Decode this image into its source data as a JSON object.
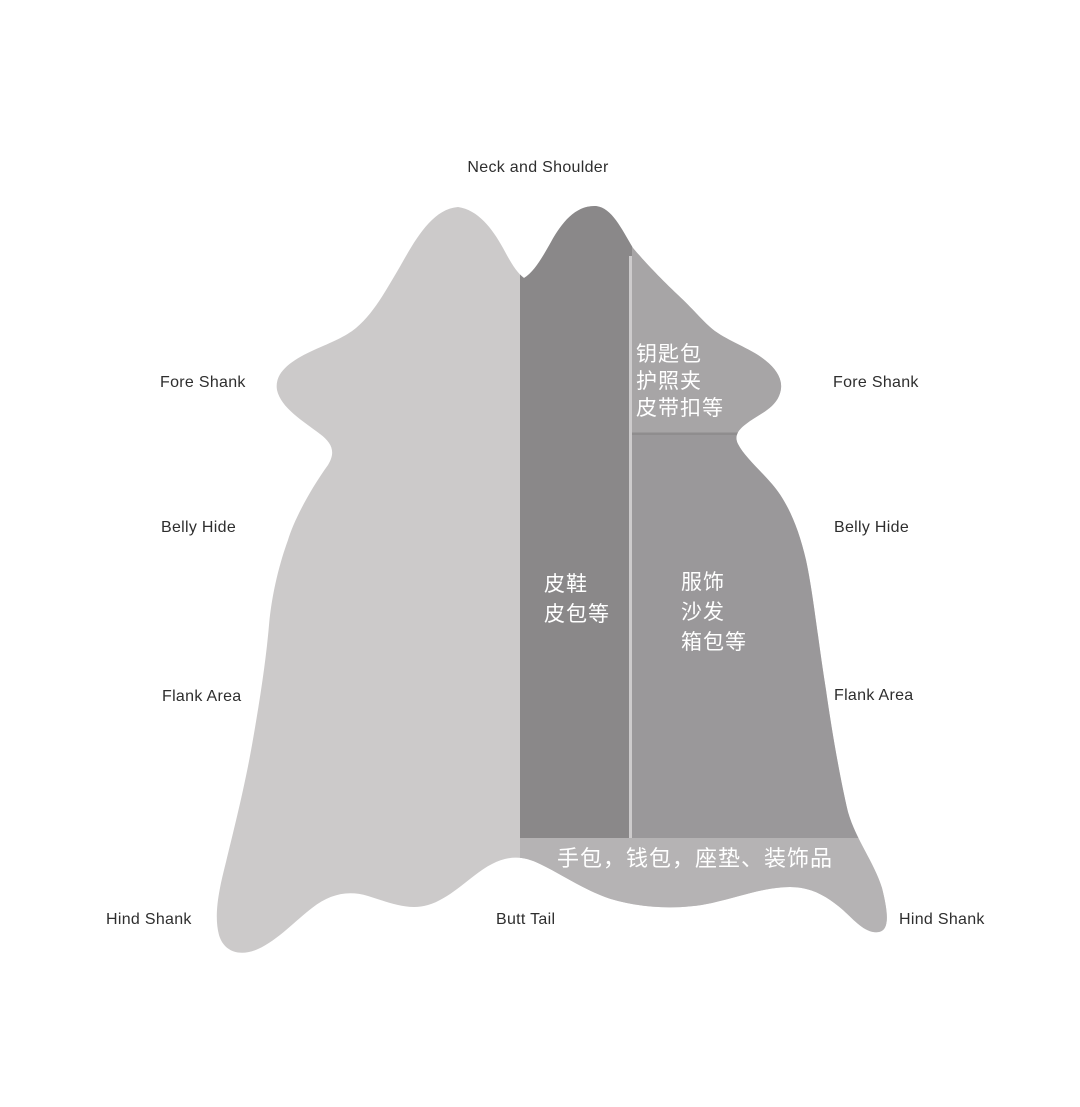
{
  "diagram": {
    "description": "Cow hide leather cutting zones diagram",
    "top_label": "Neck and Shoulder",
    "bottom_center_label": "Butt Tail",
    "left_labels": {
      "fore_shank": "Fore Shank",
      "belly_hide": "Belly Hide",
      "flank_area": "Flank Area",
      "hind_shank": "Hind Shank"
    },
    "right_labels": {
      "fore_shank": "Fore Shank",
      "belly_hide": "Belly Hide",
      "flank_area": "Flank Area",
      "hind_shank": "Hind Shank"
    },
    "regions": {
      "upper_right": {
        "lines": [
          "钥匙包",
          "护照夹",
          "皮带扣等"
        ]
      },
      "center_strip": {
        "lines": [
          "皮鞋",
          "皮包等"
        ]
      },
      "right_region": {
        "lines": [
          "服饰",
          "沙发",
          "箱包等"
        ]
      },
      "bottom_strip": {
        "lines": [
          "手包，钱包，座垫、装饰品"
        ]
      }
    }
  },
  "colors": {
    "background": "#ffffff",
    "hide_left_half": "#cccaca",
    "center_strip": "#8a8889",
    "upper_right_region": "#a7a5a6",
    "right_region": "#9a989a",
    "bottom_strip": "#b5b3b4",
    "divider_light": "#cdcbcc",
    "divider_dark": "#8f8d8e",
    "outer_label_text": "#2e2e2e",
    "region_label_text": "#ffffff"
  }
}
